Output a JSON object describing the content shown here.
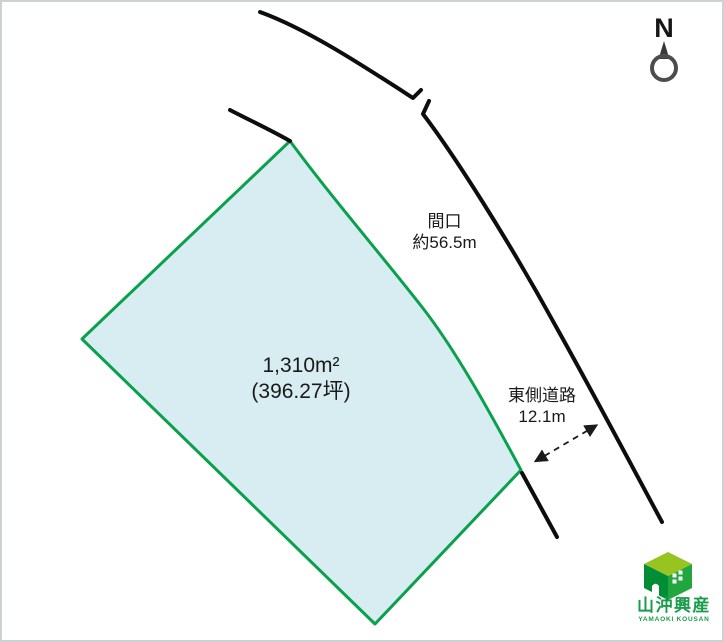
{
  "compass": {
    "label": "N"
  },
  "parcel": {
    "area_sqm": "1,310m²",
    "area_tsubo": "(396.27坪)",
    "fill_color": "#d8edf1",
    "stroke_color": "#0aa04e"
  },
  "labels": {
    "frontage_title": "間口",
    "frontage_value": "約56.5m",
    "east_road_title": "東側道路",
    "east_road_value": "12.1m"
  },
  "logo": {
    "company": "山沖興産",
    "romaji": "YAMAOKI KOUSAN",
    "brand_green": "#1a9c4b",
    "cube_top": "#97c41f",
    "cube_left": "#008d36",
    "cube_right": "#22a63e"
  }
}
